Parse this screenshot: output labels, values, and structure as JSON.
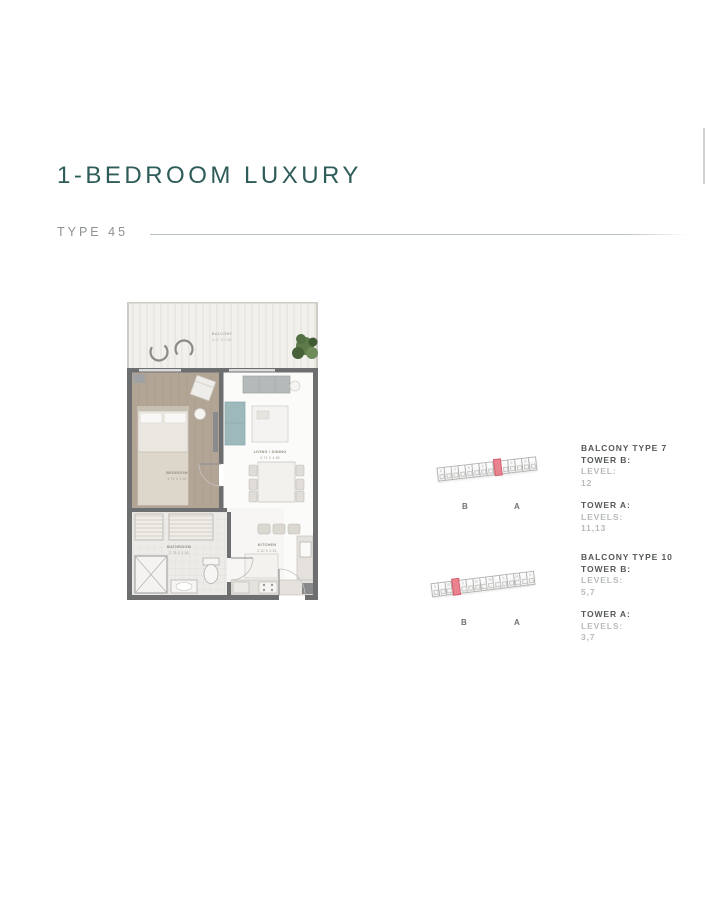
{
  "page": {
    "title": "1-BEDROOM LUXURY",
    "type_label": "TYPE 45"
  },
  "floorplan": {
    "balcony": {
      "name": "BALCONY",
      "dims": "4.97 X 1.50"
    },
    "bedroom": {
      "name": "BEDROOM",
      "dims": "3.74 X 3.30"
    },
    "living": {
      "name": "LIVING / DINING",
      "dims": "3.74 X 4.86"
    },
    "bathroom": {
      "name": "BATHROOM",
      "dims": "2.75 X 2.30"
    },
    "kitchen": {
      "name": "KITCHEN",
      "dims": "2.10 X 2.51"
    }
  },
  "keyplans": [
    {
      "cells": 14,
      "highlight_index": 8,
      "towers": [
        "B",
        "A"
      ]
    },
    {
      "cells": 15,
      "highlight_index": 3,
      "towers": [
        "B",
        "A"
      ]
    }
  ],
  "info_blocks": [
    {
      "title": "BALCONY TYPE 7",
      "sections": [
        {
          "tower": "TOWER B:",
          "levels_label": "LEVEL:",
          "levels": "12"
        },
        {
          "tower": "TOWER A:",
          "levels_label": "LEVELS:",
          "levels": "11,13"
        }
      ]
    },
    {
      "title": "BALCONY TYPE 10",
      "sections": [
        {
          "tower": "TOWER B:",
          "levels_label": "LEVELS:",
          "levels": "5,7"
        },
        {
          "tower": "TOWER A:",
          "levels_label": "LEVELS:",
          "levels": "3,7"
        }
      ]
    }
  ],
  "colors": {
    "accent_teal": "#2e5c59",
    "highlight_pink": "#ea8390",
    "wall_gray": "#6c6e70"
  }
}
